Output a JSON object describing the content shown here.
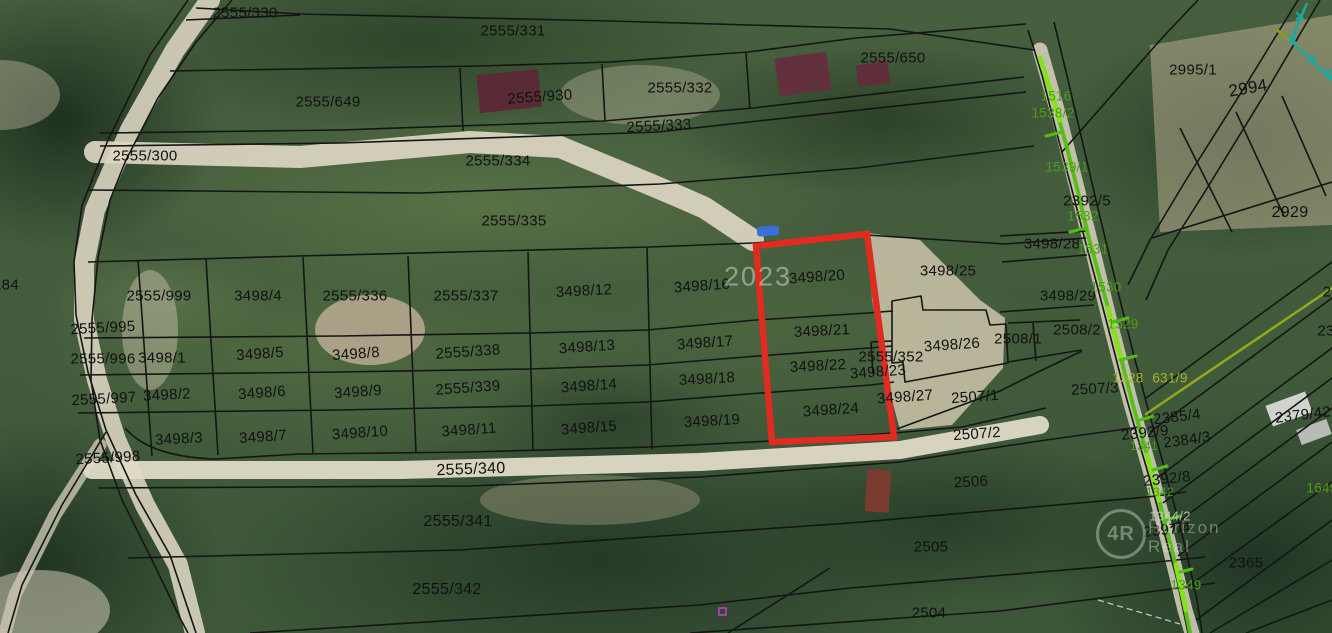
{
  "map": {
    "watermark_year": "2023",
    "logo": {
      "monogram": "4R",
      "line1": "Horizon",
      "line2": "Real"
    },
    "colors": {
      "highlight_red": "#df2b20",
      "boundary_black": "#151515",
      "utility_green": "#54bd12",
      "utility_chartreuse": "#87e01e",
      "survey_teal": "#1ba8a0",
      "utility_olive": "#93a81c",
      "label_green": "#4e9a1e",
      "label_yellow": "#a8b226",
      "sand": "#d9d3bf",
      "marker_magenta": "#c93bc9"
    },
    "parcel_labels": [
      {
        "t": "2555/330",
        "x": 245,
        "y": 13
      },
      {
        "t": "2555/331",
        "x": 513,
        "y": 31
      },
      {
        "t": "2555/650",
        "x": 893,
        "y": 58
      },
      {
        "t": "2555/649",
        "x": 328,
        "y": 102
      },
      {
        "t": "2555/930",
        "x": 540,
        "y": 97,
        "r": -4
      },
      {
        "t": "2555/332",
        "x": 680,
        "y": 88
      },
      {
        "t": "2555/333",
        "x": 659,
        "y": 126,
        "r": -3
      },
      {
        "t": "2555/300",
        "x": 145,
        "y": 156
      },
      {
        "t": "2555/334",
        "x": 498,
        "y": 161
      },
      {
        "t": "2555/335",
        "x": 514,
        "y": 221
      },
      {
        "t": "2995/1",
        "x": 1193,
        "y": 70
      },
      {
        "t": "2994",
        "x": 1248,
        "y": 88,
        "s": 17,
        "r": -10
      },
      {
        "t": "2929",
        "x": 1290,
        "y": 213,
        "s": 16
      },
      {
        "t": "2392/5",
        "x": 1087,
        "y": 201
      },
      {
        "t": "3498/28",
        "x": 1052,
        "y": 244
      },
      {
        "t": "3498/25",
        "x": 948,
        "y": 271
      },
      {
        "t": "3498/29",
        "x": 1068,
        "y": 296
      },
      {
        "t": "2508/2",
        "x": 1077,
        "y": 330
      },
      {
        "t": "2508/1",
        "x": 1018,
        "y": 339
      },
      {
        "t": "184",
        "x": 6,
        "y": 285
      },
      {
        "t": "2555/999",
        "x": 159,
        "y": 296
      },
      {
        "t": "3498/4",
        "x": 258,
        "y": 296
      },
      {
        "t": "2555/336",
        "x": 355,
        "y": 296
      },
      {
        "t": "2555/337",
        "x": 466,
        "y": 296
      },
      {
        "t": "3498/12",
        "x": 584,
        "y": 291,
        "r": -3
      },
      {
        "t": "3498/16",
        "x": 702,
        "y": 286,
        "r": -4
      },
      {
        "t": "3498/20",
        "x": 817,
        "y": 277,
        "r": -4
      },
      {
        "t": "2555/995",
        "x": 103,
        "y": 328,
        "r": -3
      },
      {
        "t": "2555/996",
        "x": 103,
        "y": 359
      },
      {
        "t": "3498/1",
        "x": 162,
        "y": 358
      },
      {
        "t": "3498/5",
        "x": 260,
        "y": 354,
        "r": -4
      },
      {
        "t": "3498/8",
        "x": 356,
        "y": 354,
        "r": -4
      },
      {
        "t": "2555/338",
        "x": 468,
        "y": 352,
        "r": -4
      },
      {
        "t": "3498/13",
        "x": 587,
        "y": 347,
        "r": -4
      },
      {
        "t": "3498/17",
        "x": 705,
        "y": 343,
        "r": -4
      },
      {
        "t": "3498/21",
        "x": 822,
        "y": 331,
        "r": -3
      },
      {
        "t": "2555/352",
        "x": 891,
        "y": 357
      },
      {
        "t": "3498/26",
        "x": 952,
        "y": 345,
        "r": -4
      },
      {
        "t": "2555/997",
        "x": 104,
        "y": 399,
        "r": -3
      },
      {
        "t": "3498/2",
        "x": 167,
        "y": 395,
        "r": -3
      },
      {
        "t": "3498/6",
        "x": 262,
        "y": 393,
        "r": -4
      },
      {
        "t": "3498/9",
        "x": 358,
        "y": 392,
        "r": -4
      },
      {
        "t": "2555/339",
        "x": 468,
        "y": 388,
        "r": -4
      },
      {
        "t": "3498/14",
        "x": 589,
        "y": 386,
        "r": -4
      },
      {
        "t": "3498/18",
        "x": 707,
        "y": 379,
        "r": -3
      },
      {
        "t": "3498/22",
        "x": 818,
        "y": 366,
        "r": -3
      },
      {
        "t": "3498/23",
        "x": 878,
        "y": 372,
        "r": -4
      },
      {
        "t": "3498/27",
        "x": 905,
        "y": 397,
        "r": -4
      },
      {
        "t": "2507/1",
        "x": 975,
        "y": 397,
        "r": -4
      },
      {
        "t": "3498/3",
        "x": 179,
        "y": 439,
        "r": -3
      },
      {
        "t": "3498/7",
        "x": 263,
        "y": 437,
        "r": -4
      },
      {
        "t": "3498/10",
        "x": 360,
        "y": 433,
        "r": -4
      },
      {
        "t": "3498/11",
        "x": 469,
        "y": 430,
        "r": -4
      },
      {
        "t": "3498/15",
        "x": 589,
        "y": 428,
        "r": -4
      },
      {
        "t": "3498/19",
        "x": 712,
        "y": 421,
        "r": -3
      },
      {
        "t": "3498/24",
        "x": 831,
        "y": 410,
        "r": -4
      },
      {
        "t": "2507/2",
        "x": 977,
        "y": 434,
        "r": -4
      },
      {
        "t": "2507/3",
        "x": 1095,
        "y": 389,
        "r": -3
      },
      {
        "t": "2555/998",
        "x": 108,
        "y": 458,
        "r": -3
      },
      {
        "t": "2555/340",
        "x": 471,
        "y": 470,
        "s": 16,
        "r": -2
      },
      {
        "t": "2506",
        "x": 971,
        "y": 482,
        "r": -3
      },
      {
        "t": "2555/341",
        "x": 458,
        "y": 522,
        "s": 16
      },
      {
        "t": "2505",
        "x": 931,
        "y": 547
      },
      {
        "t": "2555/342",
        "x": 447,
        "y": 590,
        "s": 16
      },
      {
        "t": "2504",
        "x": 929,
        "y": 613
      },
      {
        "t": "2365",
        "x": 1246,
        "y": 563
      },
      {
        "t": "2392/9",
        "x": 1145,
        "y": 433,
        "r": -6
      },
      {
        "t": "2385/4",
        "x": 1177,
        "y": 417,
        "r": -7
      },
      {
        "t": "2384/3",
        "x": 1187,
        "y": 440,
        "r": -8
      },
      {
        "t": "2379/42",
        "x": 1303,
        "y": 415,
        "r": -7
      },
      {
        "t": "2392/8",
        "x": 1167,
        "y": 479,
        "r": -6
      },
      {
        "t": "2397/4",
        "x": 1167,
        "y": 530,
        "r": -6
      },
      {
        "t": "2",
        "x": 1327,
        "y": 292
      },
      {
        "t": "23",
        "x": 1326,
        "y": 331
      },
      {
        "t": "1516",
        "x": 1056,
        "y": 96,
        "c": "g"
      },
      {
        "t": "1538/2",
        "x": 1053,
        "y": 113,
        "c": "g"
      },
      {
        "t": "1539/1",
        "x": 1067,
        "y": 167,
        "c": "g"
      },
      {
        "t": "1532",
        "x": 1083,
        "y": 216,
        "c": "g"
      },
      {
        "t": "1531",
        "x": 1093,
        "y": 249,
        "c": "g"
      },
      {
        "t": "1530",
        "x": 1106,
        "y": 287,
        "c": "g"
      },
      {
        "t": "1529",
        "x": 1123,
        "y": 324,
        "c": "g"
      },
      {
        "t": "1528",
        "x": 1128,
        "y": 378,
        "c": "y"
      },
      {
        "t": "631/9",
        "x": 1170,
        "y": 378,
        "c": "y"
      },
      {
        "t": "1341",
        "x": 1144,
        "y": 446,
        "c": "g",
        "s": 12
      },
      {
        "t": "1342",
        "x": 1160,
        "y": 492,
        "c": "g",
        "s": 12
      },
      {
        "t": "1344/2",
        "x": 1170,
        "y": 516,
        "c": "gr"
      },
      {
        "t": "1349",
        "x": 1186,
        "y": 585,
        "c": "g"
      },
      {
        "t": "1649",
        "x": 1322,
        "y": 488,
        "c": "g"
      },
      {
        "t": "2023",
        "x": 758,
        "y": 277,
        "c": "wm"
      }
    ]
  }
}
